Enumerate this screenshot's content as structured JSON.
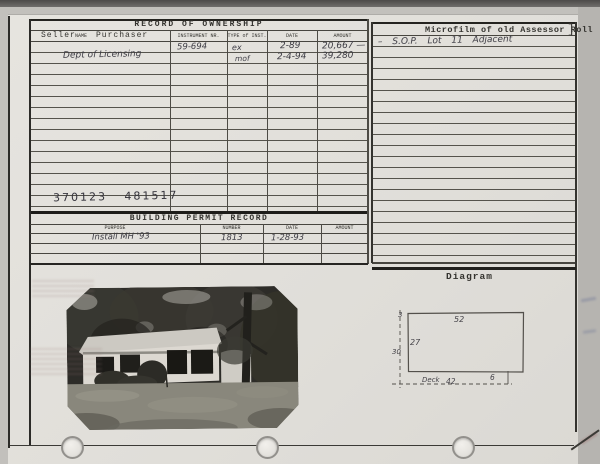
{
  "ownership": {
    "title": "RECORD OF OWNERSHIP",
    "col_seller": "Seller",
    "col_name": "NAME",
    "col_purchaser": "Purchaser",
    "col_instrument": "INSTRUMENT NR.",
    "col_type": "TYPE of INST.",
    "col_date": "DATE",
    "col_amount": "AMOUNT",
    "rows": [
      {
        "seller": "",
        "instrument": "59-694",
        "type": "ex",
        "date": "2-89",
        "amount": "20,667 —"
      },
      {
        "seller": "Dept of Licensing",
        "instrument": "",
        "type": "mof",
        "date": "2-4-94",
        "amount": "39,280"
      }
    ],
    "parcel_numbers": "370123 481517"
  },
  "microfilm": {
    "title": "Microfilm of old Assessor Roll",
    "bracket": "]",
    "entry": "– S.O.P. Lot 11 Adjacent"
  },
  "permit": {
    "title": "BUILDING PERMIT RECORD",
    "col_purpose": "PURPOSE",
    "col_number": "NUMBER",
    "col_date": "DATE",
    "col_amount": "AMOUNT",
    "rows": [
      {
        "purpose": "Install MH '93",
        "number": "1813",
        "date": "1-28-93",
        "amount": ""
      }
    ]
  },
  "diagram": {
    "title": "Diagram",
    "label_top_offset": "3",
    "label_width": "52",
    "label_height": "27",
    "label_left": "30",
    "label_deck": "Deck",
    "label_deck_len": "42",
    "label_right_offset": "6"
  },
  "photo": {
    "name": "property-photograph"
  },
  "colors": {
    "card": "#e4e2dd",
    "line": "#47453f",
    "ink": "#3e3d45",
    "print": "#34332f"
  }
}
